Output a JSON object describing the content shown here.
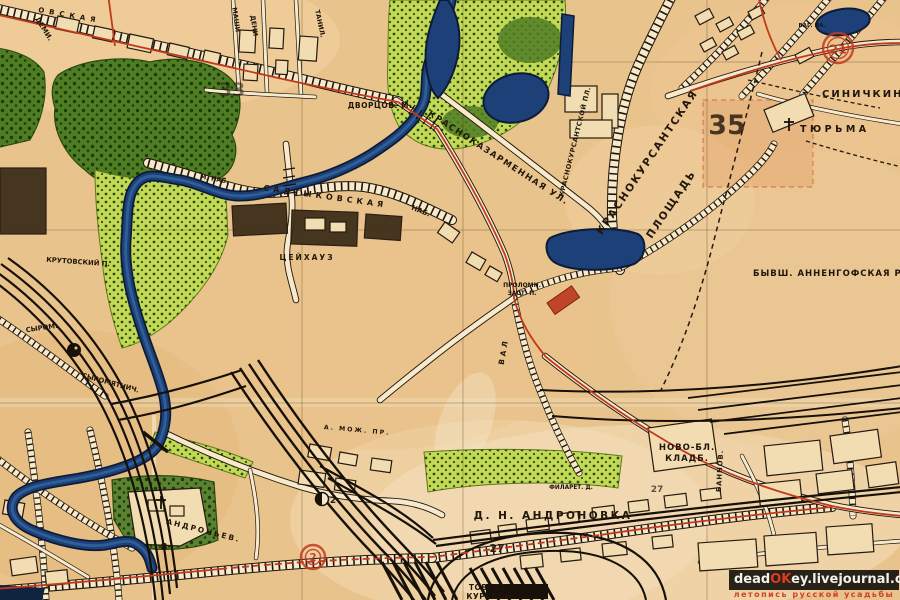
{
  "map": {
    "colors": {
      "paper": "#e9c38c",
      "river": "#1d4078",
      "river_edge": "#0c1c38",
      "park_dark": "#4f7d24",
      "park_light": "#c3d855",
      "tram_red": "#c23a1c",
      "number_red": "#c43a1a",
      "ink": "#20160b"
    },
    "labels": [
      {
        "name": "label-street-ovskaya",
        "text": "ОВСКАЯ",
        "x": 38,
        "y": 12,
        "rot": 10,
        "size": 7,
        "spacing": 5,
        "anchor": "start"
      },
      {
        "name": "label-demi",
        "text": "ДЕМИ.",
        "x": 42,
        "y": 30,
        "rot": 58,
        "size": 7
      },
      {
        "name": "label-mashi",
        "text": "МАШИ",
        "x": 234,
        "y": 20,
        "rot": 82,
        "size": 6.5
      },
      {
        "name": "label-deni",
        "text": "ДЕНИ",
        "x": 252,
        "y": 26,
        "rot": 82,
        "size": 6.5
      },
      {
        "name": "label-tanil",
        "text": "ТАНИЛ.",
        "x": 318,
        "y": 24,
        "rot": 78,
        "size": 6.5
      },
      {
        "name": "label-dvortsov-bridge",
        "text": "ДВОРЦОВ. М.",
        "x": 380,
        "y": 108,
        "size": 7.5,
        "spacing": 0.5
      },
      {
        "name": "label-m-nab",
        "text": "М. НАБ.",
        "x": 214,
        "y": 181,
        "rot": 10,
        "size": 6.5
      },
      {
        "name": "label-saltykovskaya",
        "text": "САЛТЫКОВСКАЯ",
        "x": 325,
        "y": 199,
        "rot": 8,
        "size": 8,
        "spacing": 4
      },
      {
        "name": "label-nab",
        "text": "НАБ.",
        "x": 420,
        "y": 213,
        "rot": 22,
        "size": 7
      },
      {
        "name": "label-tseykhauz",
        "text": "ЦЕЙХАУЗ",
        "x": 307,
        "y": 260,
        "size": 7.5,
        "spacing": 2
      },
      {
        "name": "label-krasnokazarmennaya",
        "text": "КРАСНОКАЗАРМЕННАЯ УЛ.",
        "x": 497,
        "y": 160,
        "rot": 33,
        "size": 8.5,
        "spacing": 1.5
      },
      {
        "name": "label-krasnokursantskoy-pl",
        "text": "КРАСНОКУРСАНТСКОЙ ПЛ.",
        "x": 577,
        "y": 142,
        "rot": -76,
        "size": 6.5,
        "spacing": 0.5
      },
      {
        "name": "label-krasnokursantskaya-1",
        "text": "КРАСНОКУРСАНТСКАЯ",
        "x": 650,
        "y": 164,
        "rot": -56,
        "size": 10.5,
        "spacing": 2
      },
      {
        "name": "label-krasnokursantskaya-2",
        "text": "ПЛОЩАДЬ",
        "x": 674,
        "y": 206,
        "rot": -56,
        "size": 10.5,
        "spacing": 2
      },
      {
        "name": "label-sinichkina",
        "text": "СИНИЧКИНА",
        "x": 822,
        "y": 97,
        "size": 10,
        "spacing": 2,
        "anchor": "start"
      },
      {
        "name": "label-tyurma",
        "text": "ТЮРЬМА",
        "x": 800,
        "y": 132,
        "size": 9.5,
        "spacing": 3.5,
        "anchor": "start"
      },
      {
        "name": "label-vag-pa",
        "text": "ВАГ. ПА.",
        "x": 812,
        "y": 27,
        "size": 5.5
      },
      {
        "name": "label-annenhof-grove",
        "text": "БЫВШ. АННЕНГОФСКАЯ РОЩА",
        "x": 753,
        "y": 276,
        "size": 8.5,
        "spacing": 1,
        "anchor": "start"
      },
      {
        "name": "label-prolomn",
        "text": "ПРОЛОМН.",
        "x": 522,
        "y": 287,
        "size": 6
      },
      {
        "name": "label-zast",
        "text": "ЗАСТ. П.",
        "x": 522,
        "y": 295,
        "size": 6
      },
      {
        "name": "label-val",
        "text": "ВАЛ",
        "x": 506,
        "y": 352,
        "rot": -80,
        "size": 7.5,
        "spacing": 3
      },
      {
        "name": "label-novo-bl-1",
        "text": "НОВО-БЛ.",
        "x": 687,
        "y": 450,
        "size": 8.5,
        "color": "#c0391f",
        "spacing": 1
      },
      {
        "name": "label-novo-bl-2",
        "text": "КЛАДБ.",
        "x": 687,
        "y": 461,
        "size": 8.5,
        "color": "#c0391f",
        "spacing": 1
      },
      {
        "name": "label-andronovka",
        "text": "Д. Н. АНДРОНОВКА",
        "x": 553,
        "y": 519,
        "size": 10.5,
        "spacing": 2.5
      },
      {
        "name": "label-tov-st",
        "text": "ТОВ. СТ.",
        "x": 489,
        "y": 590,
        "size": 7.5,
        "spacing": 0.5
      },
      {
        "name": "label-kurskoy",
        "text": "КУРСКОЙ",
        "x": 489,
        "y": 599,
        "size": 7.5,
        "spacing": 0.5
      },
      {
        "name": "label-filaret",
        "text": "ФИЛАРЕТ. Д.",
        "x": 571,
        "y": 489,
        "size": 5.8
      },
      {
        "name": "label-andronyev",
        "text": "АНДРОНЬЕВ.",
        "x": 203,
        "y": 533,
        "rot": 14,
        "size": 7.5,
        "spacing": 2
      },
      {
        "name": "label-krutovskiy",
        "text": "КРУТОВСКИЙ П.",
        "x": 78,
        "y": 264,
        "rot": 4,
        "size": 6.8
      },
      {
        "name": "label-syrom",
        "text": "СЫРОМ.",
        "x": 42,
        "y": 330,
        "rot": -8,
        "size": 6.8
      },
      {
        "name": "label-syromyatnich",
        "text": "СЫРОМЯТНИЧ.",
        "x": 110,
        "y": 385,
        "rot": 15,
        "size": 6.8
      },
      {
        "name": "label-bannov",
        "text": "БАННОВ.",
        "x": 722,
        "y": 471,
        "rot": -87,
        "size": 6.8,
        "spacing": 1
      },
      {
        "name": "label-mozh-pr",
        "text": "А. МОЖ. ПР.",
        "x": 357,
        "y": 432,
        "rot": 5,
        "size": 6.2,
        "spacing": 2
      },
      {
        "name": "district-number-35",
        "text": "35",
        "x": 727,
        "y": 134,
        "size": 27,
        "color": "#c43a1a",
        "opacity": 0.8
      },
      {
        "name": "district-number-33",
        "text": "33",
        "x": 232,
        "y": 96,
        "size": 19,
        "color": "#c43a1a",
        "opacity": 0.5
      },
      {
        "name": "district-number-27a",
        "text": "27",
        "x": 497,
        "y": 552,
        "size": 11,
        "color": "#c43a1a",
        "opacity": 0.9
      },
      {
        "name": "district-number-27b",
        "text": "27",
        "x": 657,
        "y": 492,
        "size": 9,
        "color": "#c43a1a",
        "opacity": 0.7
      },
      {
        "name": "route-number-8",
        "text": "8",
        "x": 164,
        "y": 550,
        "size": 10,
        "color": "#c43a1a"
      },
      {
        "name": "poi-number-2",
        "text": "2",
        "x": 333,
        "y": 503,
        "size": 9
      }
    ],
    "markers": [
      {
        "kind": "route-circle",
        "text": "21",
        "x": 838,
        "y": 48,
        "r": 15
      },
      {
        "kind": "route-circle",
        "text": "2",
        "x": 313,
        "y": 557,
        "r": 12
      },
      {
        "kind": "half-circle-poi",
        "x": 322,
        "y": 499
      },
      {
        "kind": "dot-poi",
        "x": 74,
        "y": 350
      },
      {
        "kind": "church-cross",
        "x": 789,
        "y": 125
      },
      {
        "kind": "church-cross",
        "x": 161,
        "y": 503
      }
    ]
  },
  "watermark": {
    "prefix": "dead",
    "accent": "OK",
    "suffix": "ey.livejournal.com",
    "tagline": "летопись русской усадьбы"
  }
}
